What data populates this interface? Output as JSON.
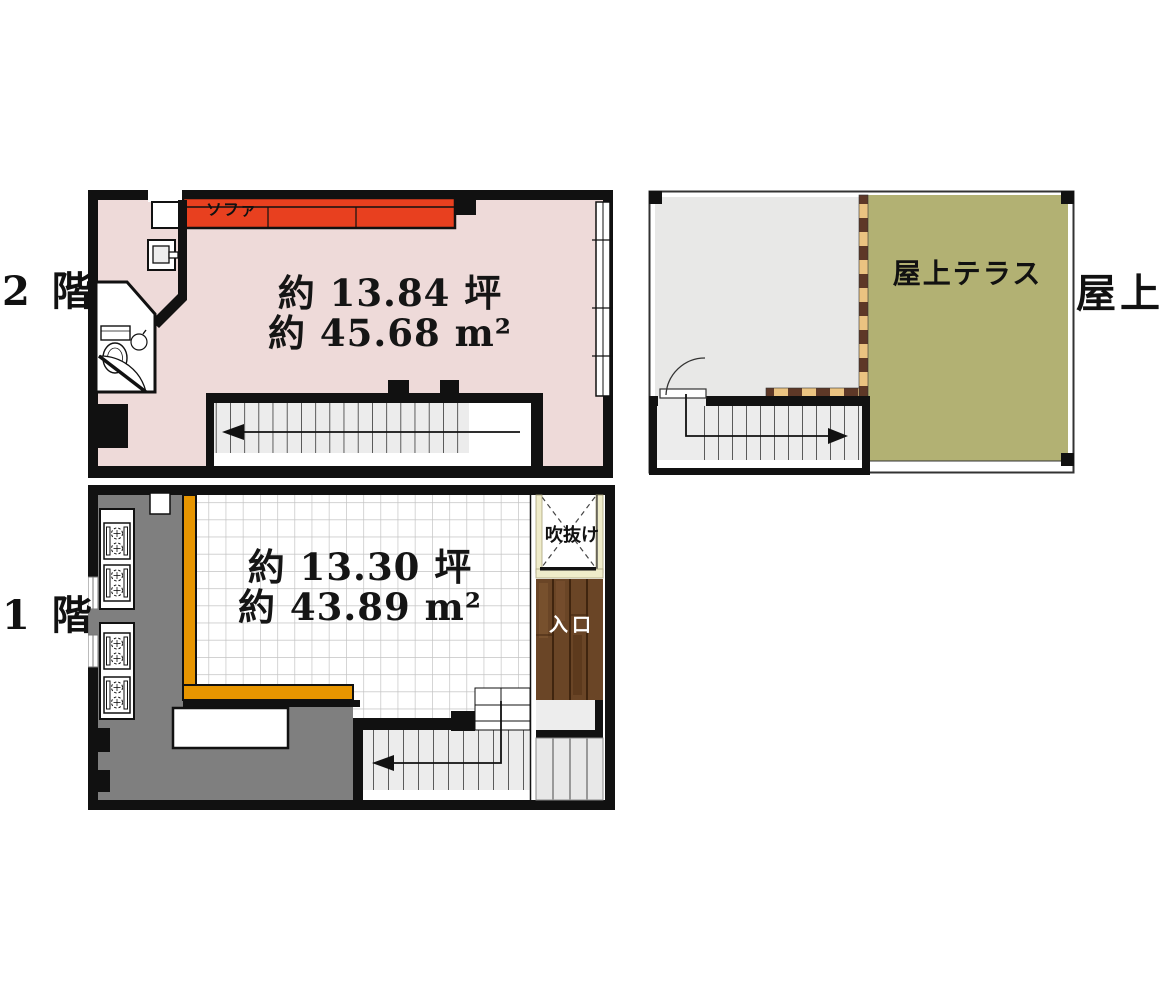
{
  "floor2": {
    "floor_label": "2 階",
    "area_tsubo": "約 13.84 坪",
    "area_sqm": "約 45.68 m²",
    "sofa": "ソファ"
  },
  "roof": {
    "floor_label": "屋上",
    "terrace": "屋上テラス"
  },
  "floor1": {
    "floor_label": "1 階",
    "area_tsubo": "約 13.30 坪",
    "area_sqm": "約 43.89 m²",
    "void": "吹抜け",
    "entrance": "入口"
  },
  "colors": {
    "wall_black": "#111111",
    "floor2_pink": "#eedad9",
    "sofa_red": "#e8401f",
    "stairs_gray": "#ececec",
    "roof_room_gray": "#e8e8e7",
    "terrace_olive": "#b2b173",
    "checker_dark": "#5e3827",
    "checker_light": "#ebc381",
    "kitchen_gray": "#7f7f7f",
    "counter_orange": "#e79500",
    "entrance_brown": "#6a4526",
    "void_cream": "#efecca"
  }
}
